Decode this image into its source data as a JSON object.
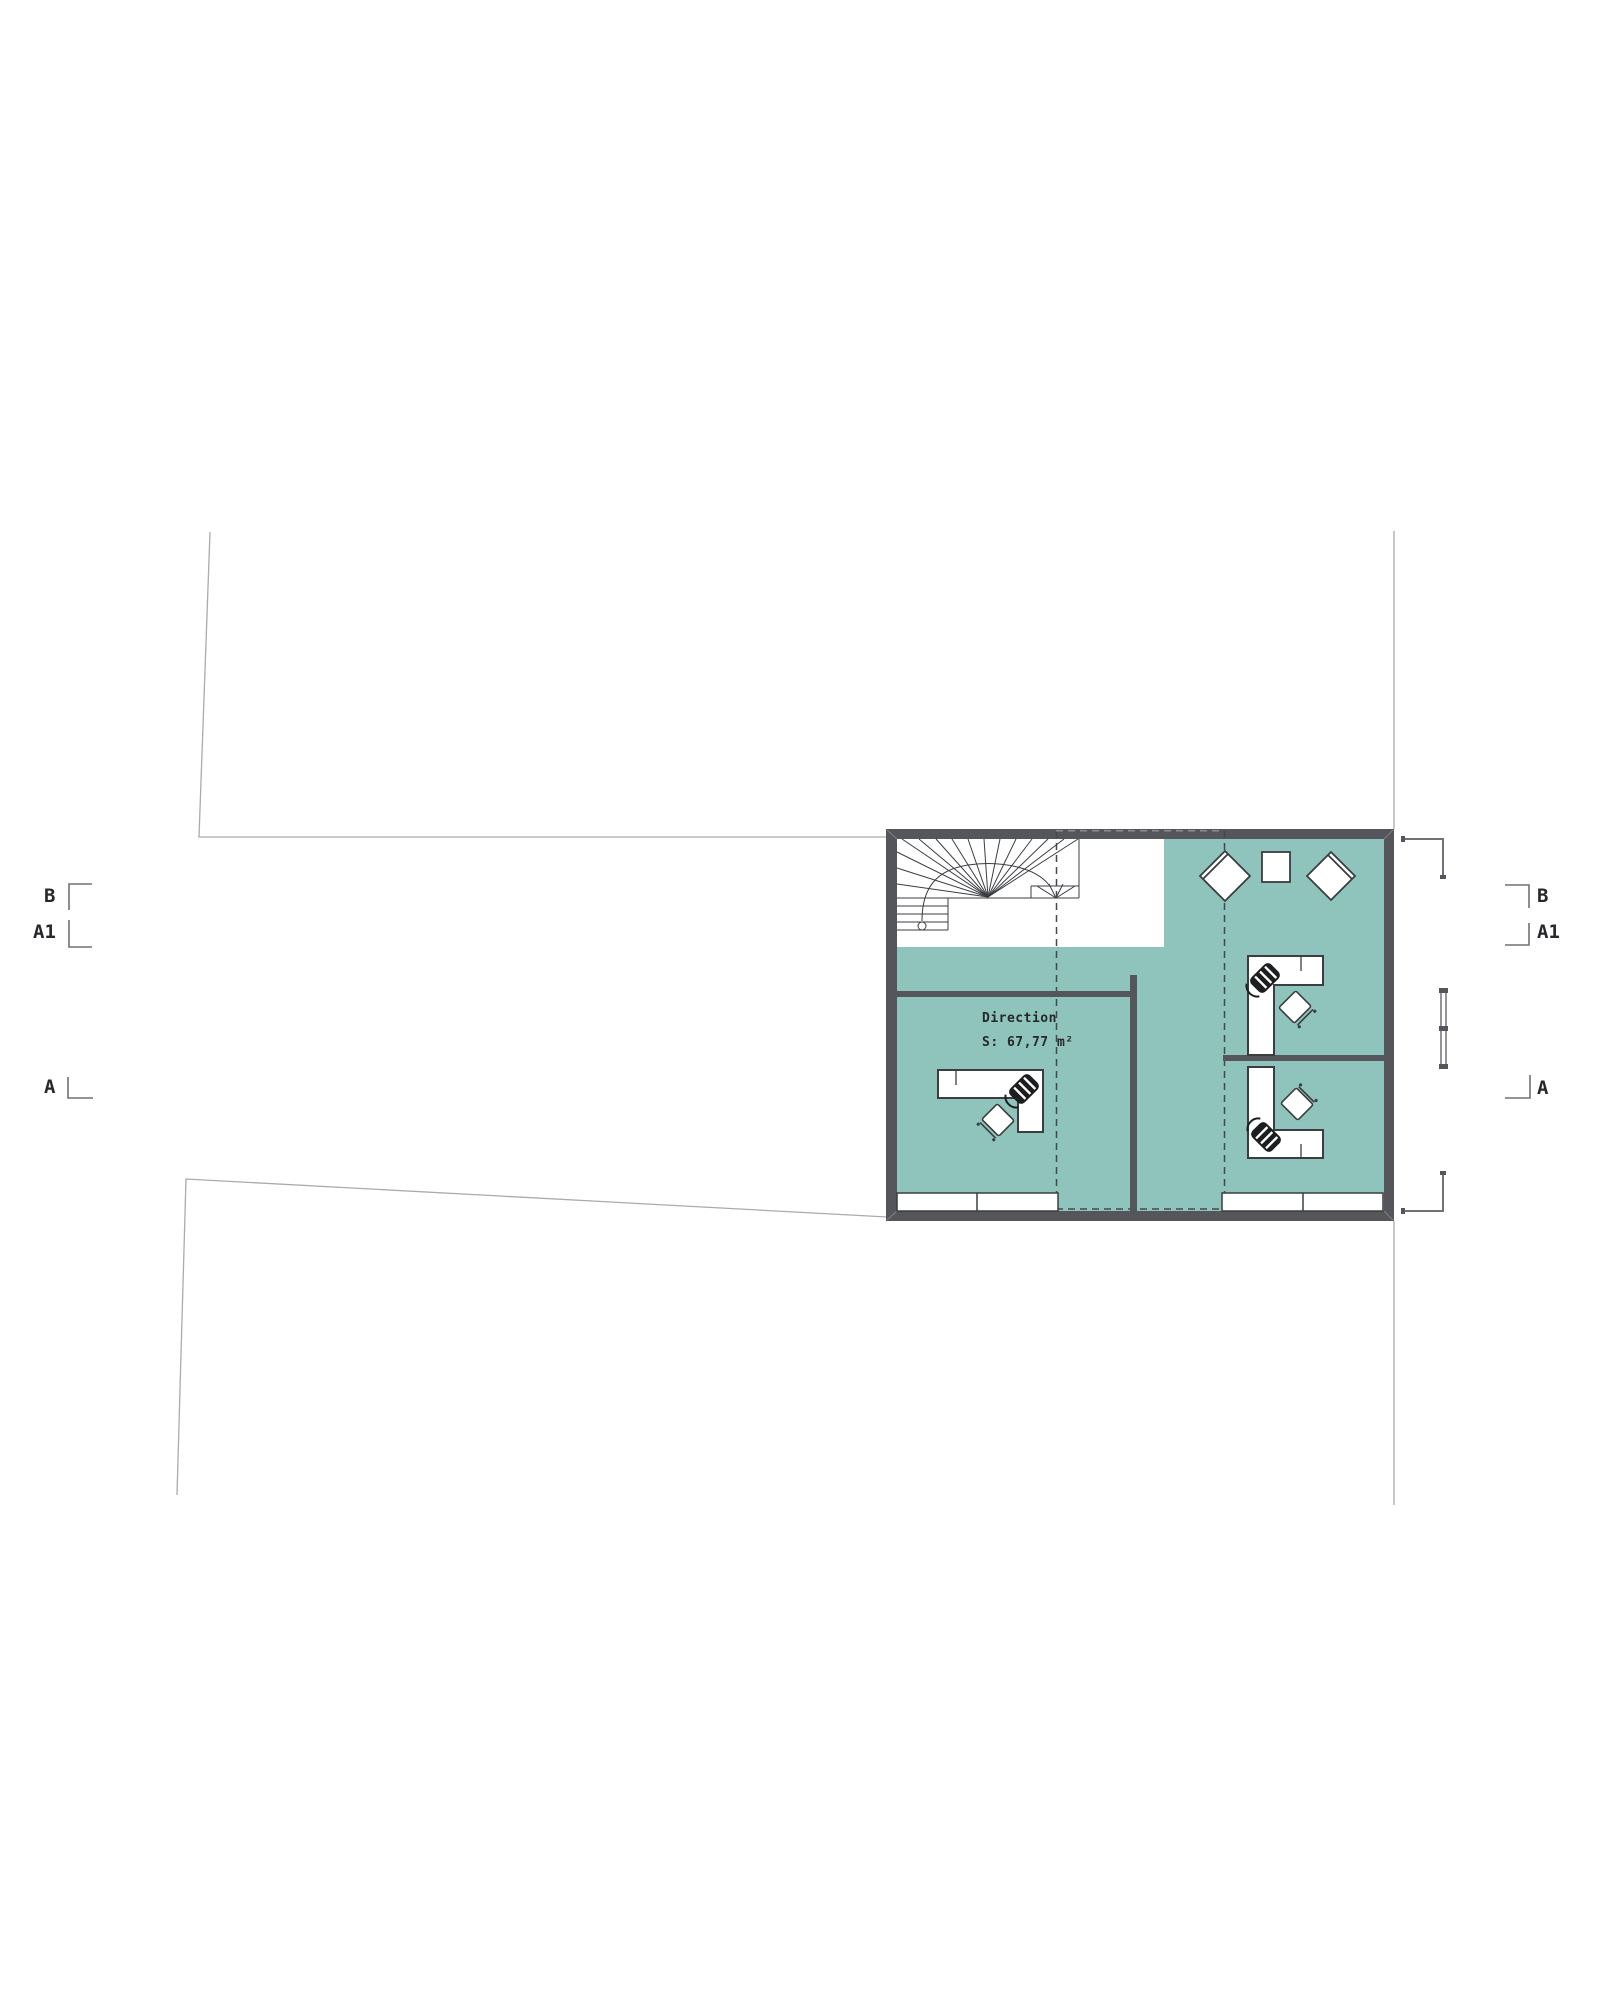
{
  "drawing_type": "floor-plan",
  "labels": {
    "room_name": "Direction",
    "room_area": "S: 67,77 m²"
  },
  "section_markers": {
    "left": [
      {
        "label": "B"
      },
      {
        "label": "A1"
      },
      {
        "label": "A"
      }
    ],
    "right": [
      {
        "label": "B"
      },
      {
        "label": "A1"
      },
      {
        "label": "A"
      }
    ]
  },
  "colors": {
    "floor_teal": "#8FC4BD",
    "wall_gray": "#54565B",
    "linework_dark": "#3B3D41",
    "boundary_gray": "#A9ABAD",
    "chair_black": "#1D1E20"
  },
  "furniture": [
    "spiral-staircase",
    "lounge-chair-left",
    "side-table",
    "lounge-chair-right",
    "l-desk-office-1",
    "office-chair-1",
    "visitor-chair-1",
    "l-desk-office-2",
    "office-chair-2",
    "visitor-chair-2",
    "l-desk-direction",
    "office-chair-3",
    "visitor-chair-3",
    "window-band-left",
    "window-band-right",
    "facade-window-right"
  ]
}
